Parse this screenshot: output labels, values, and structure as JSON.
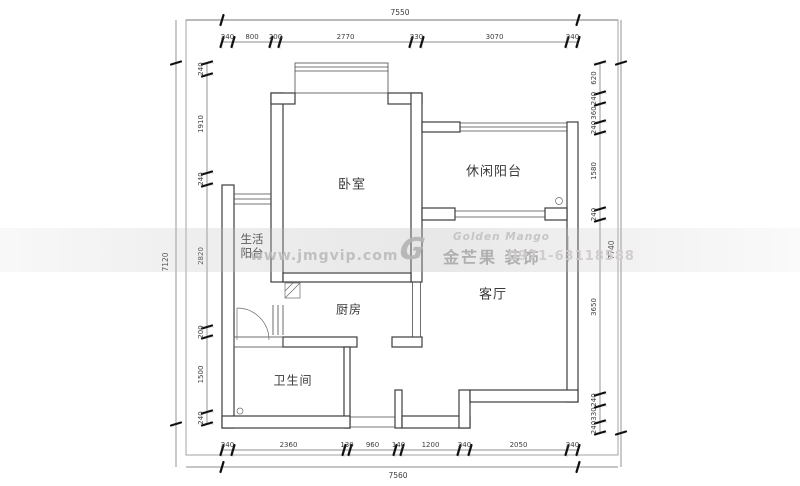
{
  "watermark": {
    "website": "www.jmgvip.com",
    "logo_mark": "G",
    "logo_en": "Golden Mango",
    "logo_cn": "金芒果 装饰",
    "phone": "0971-63118588"
  },
  "rooms": {
    "bedroom": {
      "label": "卧室"
    },
    "leisure_balcony": {
      "label": "休闲阳台"
    },
    "living_balcony": {
      "label": "生活阳台"
    },
    "kitchen": {
      "label": "厨房"
    },
    "living_room": {
      "label": "客厅"
    },
    "bathroom": {
      "label": "卫生间"
    }
  },
  "dimensions": {
    "top": {
      "total": "7550",
      "segments": [
        "240",
        "800",
        "200",
        "2770",
        "230",
        "3070",
        "240"
      ]
    },
    "bottom": {
      "total": "7560",
      "segments": [
        "240",
        "2360",
        "130",
        "960",
        "140",
        "1200",
        "240",
        "2050",
        "240"
      ]
    },
    "left": {
      "total": "7120",
      "segments": [
        "240",
        "1910",
        "240",
        "2820",
        "200",
        "1500",
        "240"
      ]
    },
    "right": {
      "total": "7740",
      "segments": [
        "620",
        "240",
        "360",
        "240",
        "1580",
        "240",
        "3650",
        "240",
        "330",
        "240"
      ]
    }
  }
}
